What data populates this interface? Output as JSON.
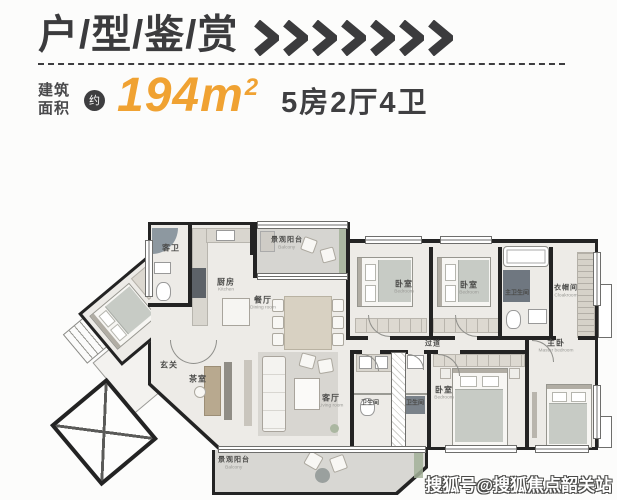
{
  "header": {
    "title": "户/型/鉴/赏",
    "chevron_count": 7
  },
  "area": {
    "label_top": "建筑",
    "label_bottom": "面积",
    "approx_badge": "约",
    "value": "194",
    "unit": "m",
    "unit_sup": "2",
    "spec": "5房2厅4卫"
  },
  "colors": {
    "accent_orange": "#F0A232",
    "ink": "#3B3B3D",
    "wall": "#232323"
  },
  "floorplan": {
    "rooms": {
      "guest_bath": {
        "label": "客卫"
      },
      "kitchen": {
        "label": "厨房",
        "en": "Kitchen"
      },
      "balcony_top": {
        "label": "景观阳台",
        "en": "Balcony"
      },
      "dining": {
        "label": "餐厅",
        "en": "Dining room"
      },
      "bedroom1": {
        "label": "卧室",
        "en": "Bedroom"
      },
      "bedroom2": {
        "label": "卧室",
        "en": "Bedroom"
      },
      "master_bath": {
        "label": "主卫生间",
        "en": "Master bathroom"
      },
      "cloakroom": {
        "label": "衣帽间",
        "en": "Cloakroom"
      },
      "corridor": {
        "label": "过道",
        "en": "Corridor"
      },
      "guest_room": {
        "label": "客房",
        "en": "Guest room"
      },
      "foyer": {
        "label": "玄关"
      },
      "tea_room": {
        "label": "茶室"
      },
      "living_room": {
        "label": "客厅",
        "en": "Living room"
      },
      "bathroom_left": {
        "label": "卫生间",
        "en": "Bathroom"
      },
      "bathroom_right": {
        "label": "卫生间",
        "en": "Bathroom"
      },
      "bedroom3": {
        "label": "卧室",
        "en": "Bedroom"
      },
      "master_bedroom": {
        "label": "主卧",
        "en": "Master bedroom"
      },
      "balcony_bottom": {
        "label": "景观阳台",
        "en": "Balcony"
      }
    }
  },
  "watermark": {
    "text": "搜狐号@搜狐焦点韶关站"
  }
}
